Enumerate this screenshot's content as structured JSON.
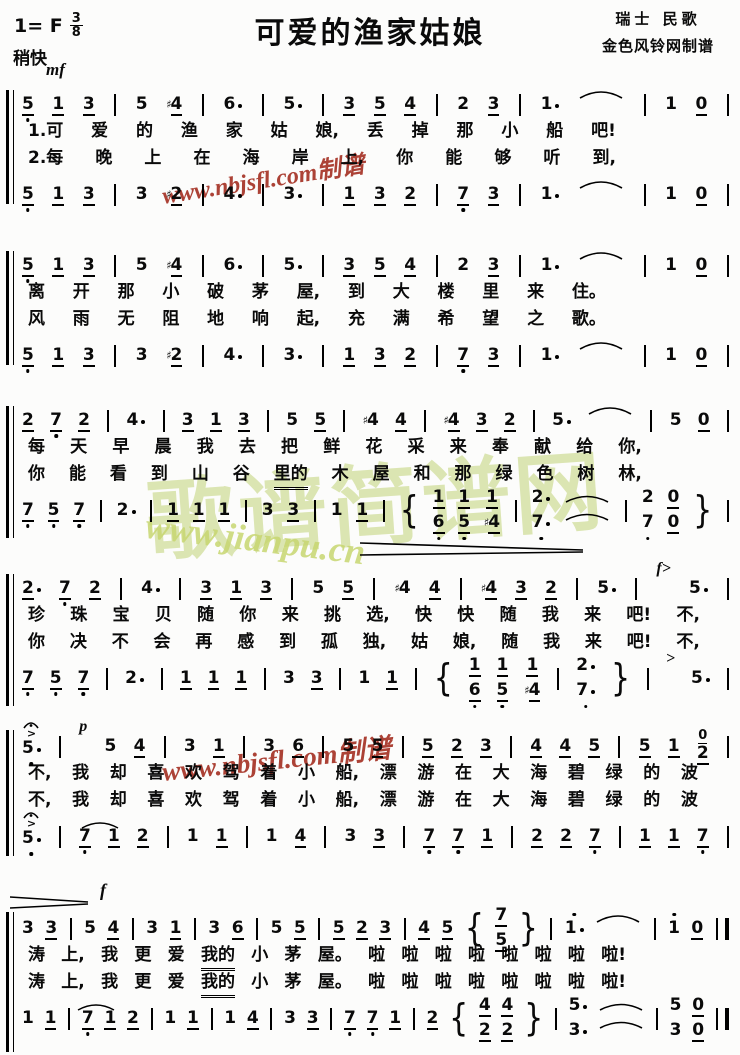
{
  "header": {
    "key_signature": "1= F",
    "time_numerator": "3",
    "time_denominator": "8",
    "tempo": "稍快",
    "start_dynamic": "mf",
    "title": "可爱的渔家姑娘",
    "credit_line1": "瑞士 民歌",
    "credit_line2": "金色风铃网制谱"
  },
  "dynamics": {
    "forte_mark": "f"
  },
  "watermarks": {
    "red_text": "www.nbjsfl.com制谱",
    "green_big_text": "歌谱简谱网",
    "green_url": "www.jianpu.cn",
    "red_color": "#a63326",
    "green_color": "#b7cc62"
  },
  "systems": [
    {
      "voice1": "5_, 1_ 3_ | 5 #4_ | 6* | 5* | 3_ 5_ 4_ | 2 3_ | 1* T | 1 0_ |",
      "lyrics1": [
        "1.可",
        "爱",
        "的",
        "渔",
        "家",
        "姑",
        "娘,",
        "丢",
        "掉",
        "那",
        "小",
        "船",
        "吧!"
      ],
      "lyrics2": [
        "2.每",
        "晚",
        "上",
        "在",
        "海",
        "岸",
        "上,",
        "你",
        "能",
        "够",
        "听",
        "到,"
      ],
      "voice2": "5_, 1_ 3_ | 3 #2_ | 4* | 3* | 1_ 3_ 2_ | 7_, 3_ | 1* T | 1 0_ |"
    },
    {
      "voice1": "5_, 1_ 3_ | 5 #4_ | 6* | 5* | 3_ 5_ 4_ | 2 3_ | 1* T | 1 0_ |",
      "lyrics1": [
        "离",
        "开",
        "那",
        "小",
        "破",
        "茅",
        "屋,",
        "到",
        "大",
        "楼",
        "里",
        "来",
        "住。"
      ],
      "lyrics2": [
        "风",
        "雨",
        "无",
        "阻",
        "地",
        "响",
        "起,",
        "充",
        "满",
        "希",
        "望",
        "之",
        "歌。"
      ],
      "voice2": "5_, 1_ 3_ | 3 #2_ | 4* | 3* | 1_ 3_ 2_ | 7_, 3_ | 1* T | 1 0_ |"
    },
    {
      "voice1": "2_ 7_, 2_ | 4* | 3_ 1_ 3_ | 5 5_ | #4 4_ | #4_ 3_ 2_ | 5* T | 5 0_ |",
      "lyrics1": [
        "每",
        "天",
        "早",
        "晨",
        "我",
        "去",
        "把",
        "鲜",
        "花",
        "采",
        "来",
        "奉",
        "献",
        "给",
        "你,"
      ],
      "lyrics2": [
        "你",
        "能",
        "看",
        "到",
        "山",
        "谷",
        "里的_",
        "木",
        "屋",
        "和",
        "那",
        "绿",
        "色",
        "树",
        "林,"
      ],
      "voice2": "7_, 5_, 7_, | 2* | 1_ 1_ 1_ | 3 3_ | 1 1_ | { 1_/6_, 1_/5_, 1_/#4_ | 2*/7*, T2 | 2/7, 0_/0_ } |"
    },
    {
      "voice1": "2*_ 7_, 2_ | 4* | 3_ 1_ 3_ | 5 5_ | #4 4_ | #4_ 3_ 2_ | 5* | (f>) 5* |",
      "lyrics1": [
        "珍",
        "珠",
        "宝",
        "贝",
        "随",
        "你",
        "来",
        "挑",
        "选,",
        "快",
        "快",
        "随",
        "我",
        "来",
        "吧!",
        "不,"
      ],
      "lyrics2": [
        "你",
        "决",
        "不",
        "会",
        "再",
        "感",
        "到",
        "孤",
        "独,",
        "姑",
        "娘,",
        "随",
        "我",
        "来",
        "吧!",
        "不,"
      ],
      "voice2": "7_, 5_, 7_, | 2* | 1_ 1_ 1_ | 3 3_ | 1 1_ | { 1_/6_, 1_/5_, 1_/#4_ | 2*/7*, } | (>) 5* |"
    },
    {
      "voice1": "F5*, | (p) 5 4_ | 3 1_ | 3 6_ | 5 5_ | 5_ 2_ 3_ | 4_ 4_ 5_ | 5_ 1_ 2_&0_ |",
      "lyrics1": [
        "不,",
        "我",
        "却",
        "喜",
        "欢",
        "驾",
        "着",
        "小",
        "船,",
        "漂",
        "游",
        "在",
        "大",
        "海",
        "碧",
        "绿",
        "的",
        "波"
      ],
      "lyrics2": [
        "不,",
        "我",
        "却",
        "喜",
        "欢",
        "驾",
        "着",
        "小",
        "船,",
        "漂",
        "游",
        "在",
        "大",
        "海",
        "碧",
        "绿",
        "的",
        "波"
      ],
      "voice2": "F5*, | 7_, 1_~ 2_ | 1 1_ | 1 4_ | 3 3_ | 7_, 7_, 1_ | 2_ 2_ 7_, | 1_ 1_ 7_, |"
    },
    {
      "voice1": "3 3_ | 5 4_ | 3 1_ | 3 6_ | 5 5_ | 5_ 2_ 3_ | 4_ 5_ { 7_/5_ } | 1'* T | 1' 0_ ||",
      "lyrics1": [
        "涛",
        "上,",
        "我",
        "更",
        "爱",
        "我的_",
        "小",
        "茅",
        "屋。",
        "啦",
        "啦",
        "啦",
        "啦",
        "啦",
        "啦",
        "啦",
        "啦!"
      ],
      "lyrics2": [
        "涛",
        "上,",
        "我",
        "更",
        "爱",
        "我的_",
        "小",
        "茅",
        "屋。",
        "啦",
        "啦",
        "啦",
        "啦",
        "啦",
        "啦",
        "啦",
        "啦!"
      ],
      "voice2": "1 1_ | 7_, 1_~ 2_ | 1 1_ | 1 4_ | 3 3_ | 7_, 7_, 1_ | 2_ { 4_/2_ 4_/2_ } | 5*/3* T2 | 5/3 0_/0_ ||"
    }
  ]
}
